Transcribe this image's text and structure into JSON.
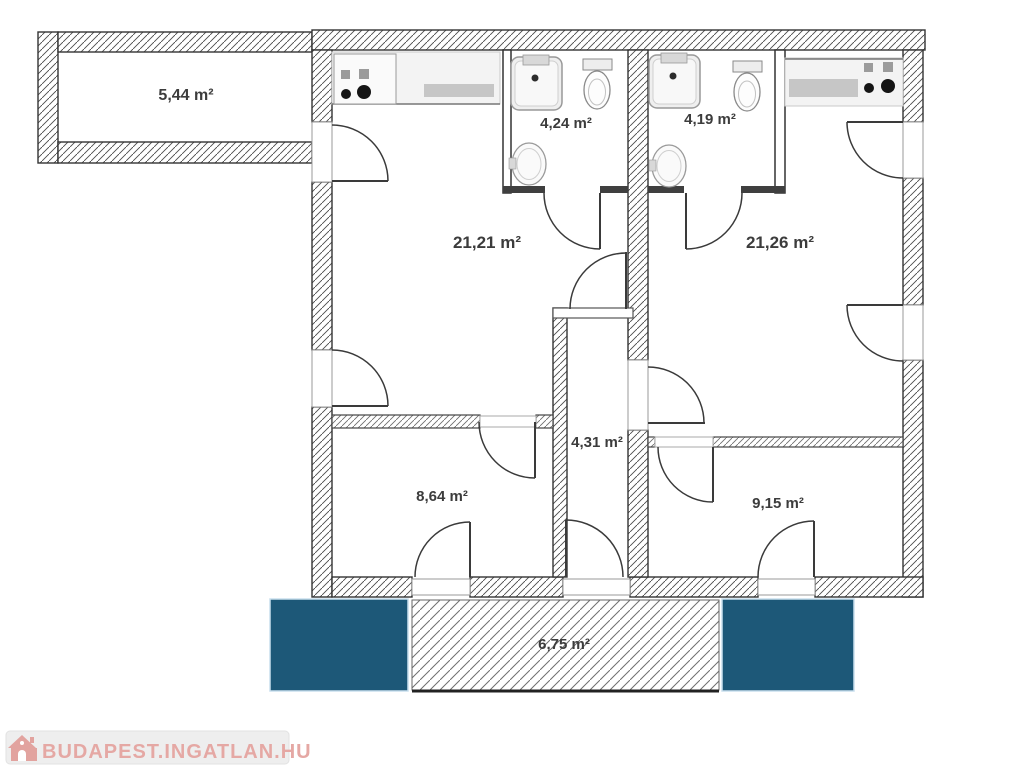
{
  "plan": {
    "rooms": {
      "loggia": {
        "label": "5,44 m²"
      },
      "bath_left": {
        "label": "4,24 m²"
      },
      "bath_right": {
        "label": "4,19 m²"
      },
      "living_left": {
        "label": "21,21 m²"
      },
      "living_right": {
        "label": "21,26 m²"
      },
      "hallway": {
        "label": "4,31 m²"
      },
      "room_small_left": {
        "label": "8,64 m²"
      },
      "room_small_right": {
        "label": "9,15 m²"
      },
      "balcony": {
        "label": "6,75 m²"
      }
    },
    "colors": {
      "terrace_fill": "#1d5878",
      "terrace_edge": "#c9dfee",
      "wall_line": "#333333",
      "label_text": "#3c3c3c"
    }
  },
  "watermark": {
    "text": "BUDAPEST.INGATLAN.HU",
    "text_color": "#e5a8a4",
    "bar_color": "#eeeeee"
  },
  "icons": [
    "house-icon",
    "stove-burners-icon",
    "kitchen-counter-sink-icon",
    "shower-icon",
    "toilet-icon",
    "washbasin-icon",
    "door-swing-arc"
  ]
}
